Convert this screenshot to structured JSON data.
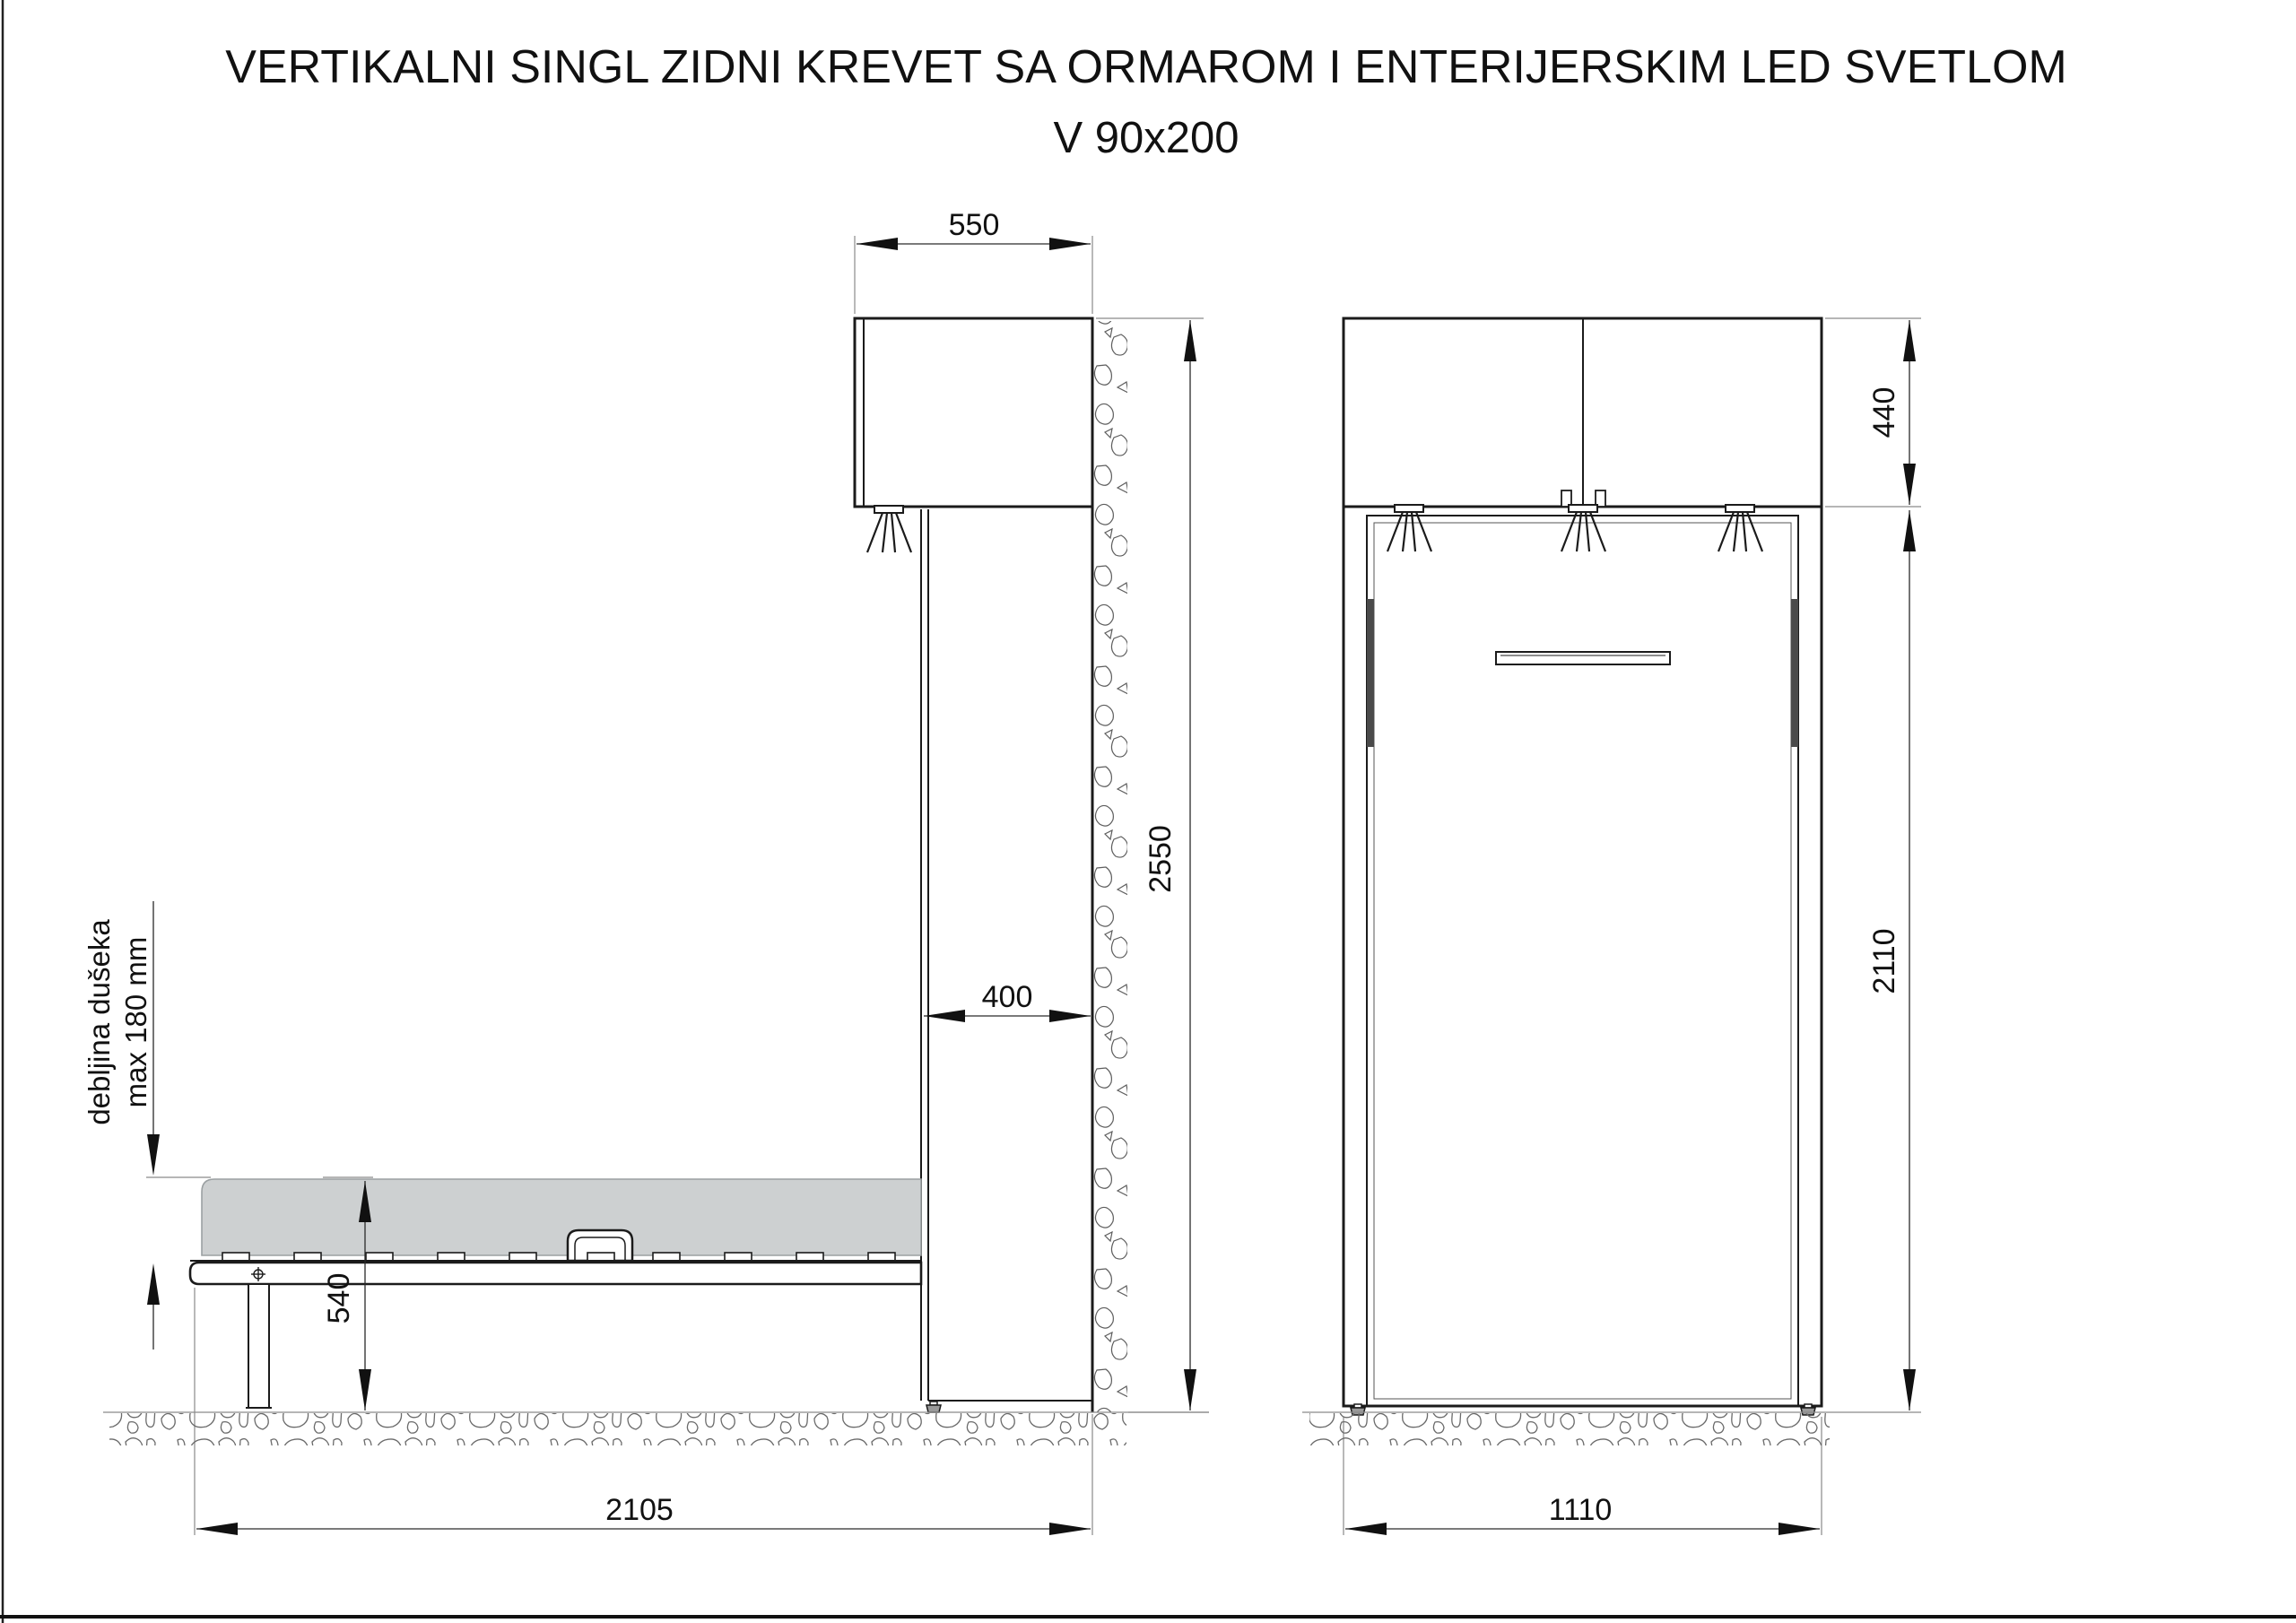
{
  "title": {
    "line1": "VERTIKALNI SINGL ZIDNI KREVET SA ORMAROM I ENTERIJERSKIM LED SVETLOM",
    "line2": "V 90x200"
  },
  "side_view": {
    "dim_wardrobe_depth": "550",
    "dim_total_height": "2550",
    "dim_column_depth": "400",
    "dim_bed_height": "540",
    "dim_open_depth": "2105",
    "mattress_note_line1": "debljina dušeka",
    "mattress_note_line2": "max 180 mm"
  },
  "front_view": {
    "dim_top_cabinet_height": "440",
    "dim_bed_panel_height": "2110",
    "dim_width": "1110"
  },
  "colors": {
    "line": "#1b1b1b",
    "mattress_fill": "#cdd0d1",
    "hardware_fill": "#4a4a4a",
    "foot_fill": "#9a9a9a"
  }
}
